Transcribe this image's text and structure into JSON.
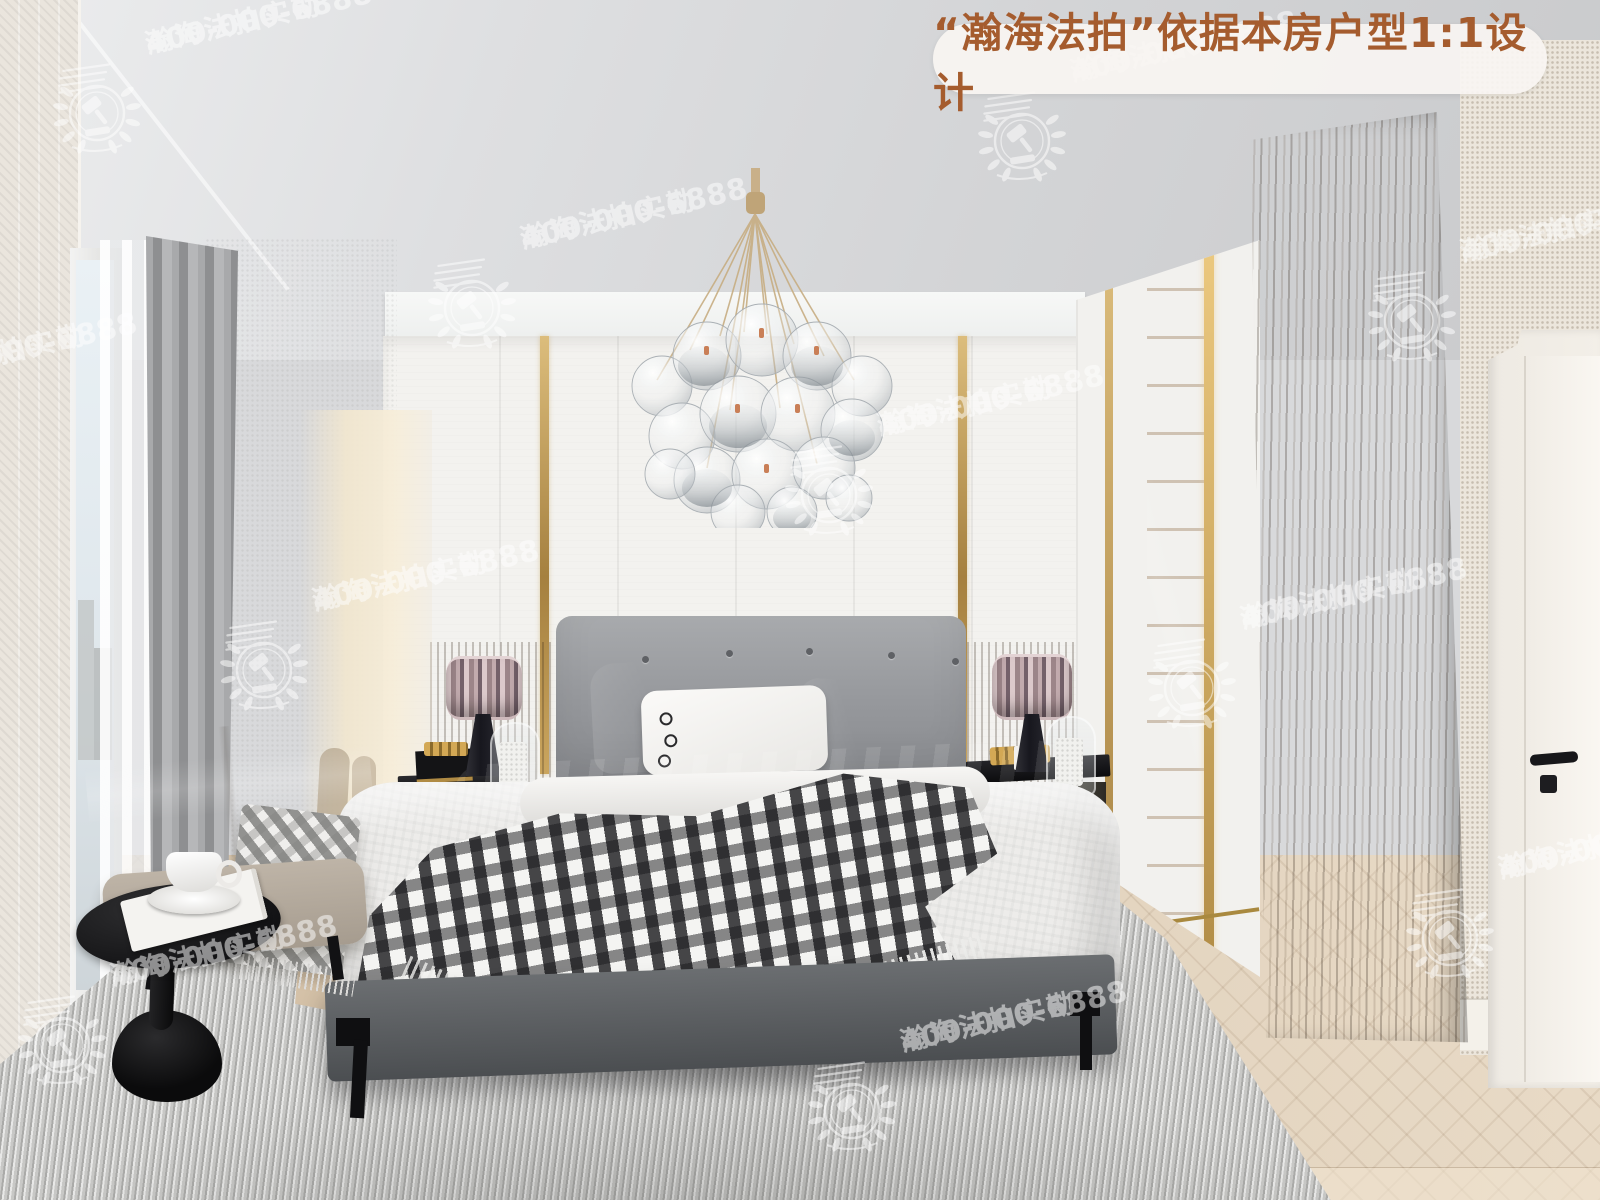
{
  "banner": {
    "text": "“瀚海法拍”依据本房户型1:1设计",
    "text_color": "#a55c2e",
    "bg_color": "rgba(248,245,242,0.92)"
  },
  "watermark": {
    "brand": "瀚海法拍实勘",
    "phone": "400-000-6888",
    "logo": "gavel-laurel-emblem",
    "color": "#ffffff",
    "opacity": 0.52,
    "positions": [
      {
        "x": 45,
        "y": 15
      },
      {
        "x": 970,
        "y": 43
      },
      {
        "x": 420,
        "y": 210
      },
      {
        "x": 1360,
        "y": 223
      },
      {
        "x": -190,
        "y": 345
      },
      {
        "x": 777,
        "y": 397
      },
      {
        "x": 212,
        "y": 572
      },
      {
        "x": 1140,
        "y": 590
      },
      {
        "x": 10,
        "y": 947
      },
      {
        "x": 800,
        "y": 1013
      },
      {
        "x": 1398,
        "y": 840
      }
    ]
  },
  "scene": {
    "book_label": "TJ"
  },
  "palette": {
    "banner_text": "#a55c2e",
    "gold_trim": "#b08b44",
    "wood_column": "#7a6a57",
    "back_wall": "#f3f2ef",
    "ceiling": "#d8d9db",
    "headboard_gray": "#97999d",
    "green_pillow": "#0f4436",
    "rug_gray": "#d5d5d3",
    "floor_wood": "#d9c8b0"
  }
}
